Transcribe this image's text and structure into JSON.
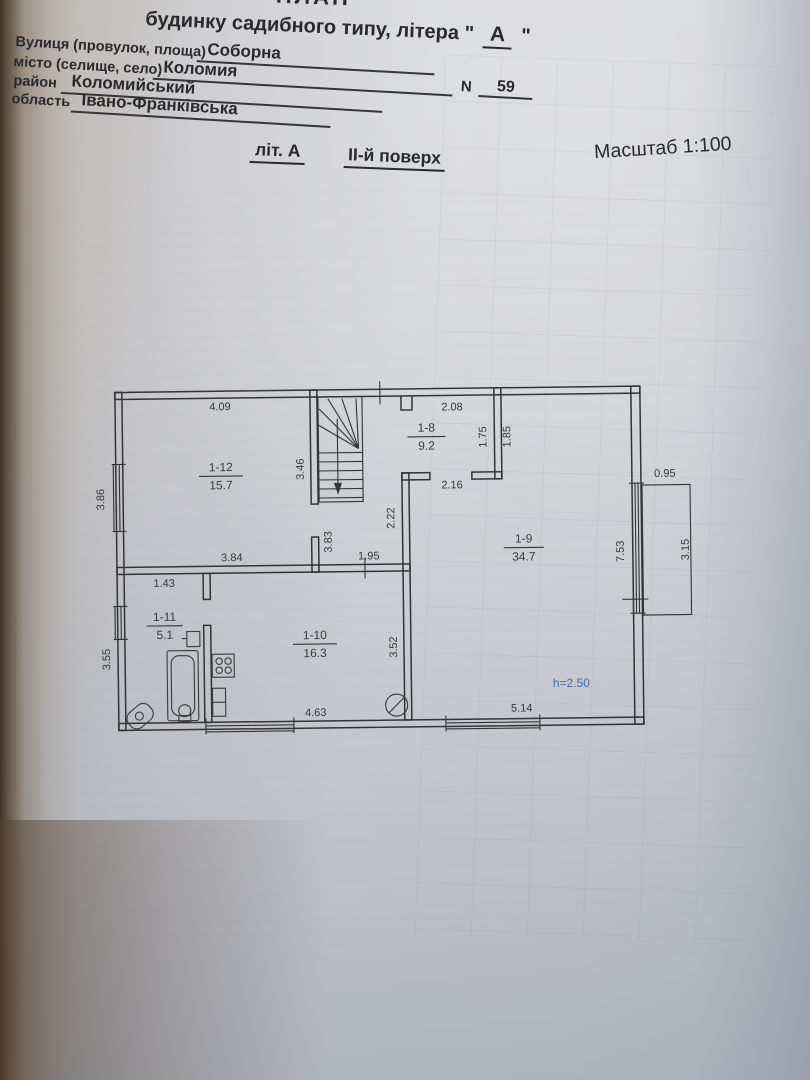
{
  "header": {
    "doc_title_partial": "ПЛАН",
    "building_line": {
      "prefix": "будинку садибного типу, літера \"",
      "letter": "А",
      "suffix": "\""
    },
    "fields": [
      {
        "label": "Вулиця (провулок, площа)",
        "value": "Соборна"
      },
      {
        "label": "місто (селище, село)",
        "value": "Коломия"
      },
      {
        "label": "район",
        "value": "Коломийський"
      },
      {
        "label": "область",
        "value": "Івано-Франківська"
      }
    ],
    "house_number": {
      "label": "N",
      "value": "59"
    }
  },
  "subtitle": {
    "lit": "літ. А",
    "floor": "ІІ-й поверх",
    "scale": "Масштаб 1:100"
  },
  "plan": {
    "rooms": {
      "r112": {
        "id": "1-12",
        "area": "15.7"
      },
      "r18": {
        "id": "1-8",
        "area": "9.2"
      },
      "r19": {
        "id": "1-9",
        "area": "34.7"
      },
      "r110": {
        "id": "1-10",
        "area": "16.3"
      },
      "r111": {
        "id": "1-11",
        "area": "5.1"
      }
    },
    "dims": {
      "w_409": "4.09",
      "h_386": "3.86",
      "h_346": "3.46",
      "w_384": "3.84",
      "h_383": "3.83",
      "w_195": "1.95",
      "h_222": "2.22",
      "w_208": "2.08",
      "h_175": "1.75",
      "h_185": "1.85",
      "w_216": "2.16",
      "h_753": "7.53",
      "w_514": "5.14",
      "w_095": "0.95",
      "h_315": "3.15",
      "h_352": "3.52",
      "w_463": "4.63",
      "w_143": "1.43",
      "h_355": "3.55"
    },
    "height_note": "h=2.50",
    "accent_blue": "#3f6ab8",
    "line_color": "#333335"
  }
}
